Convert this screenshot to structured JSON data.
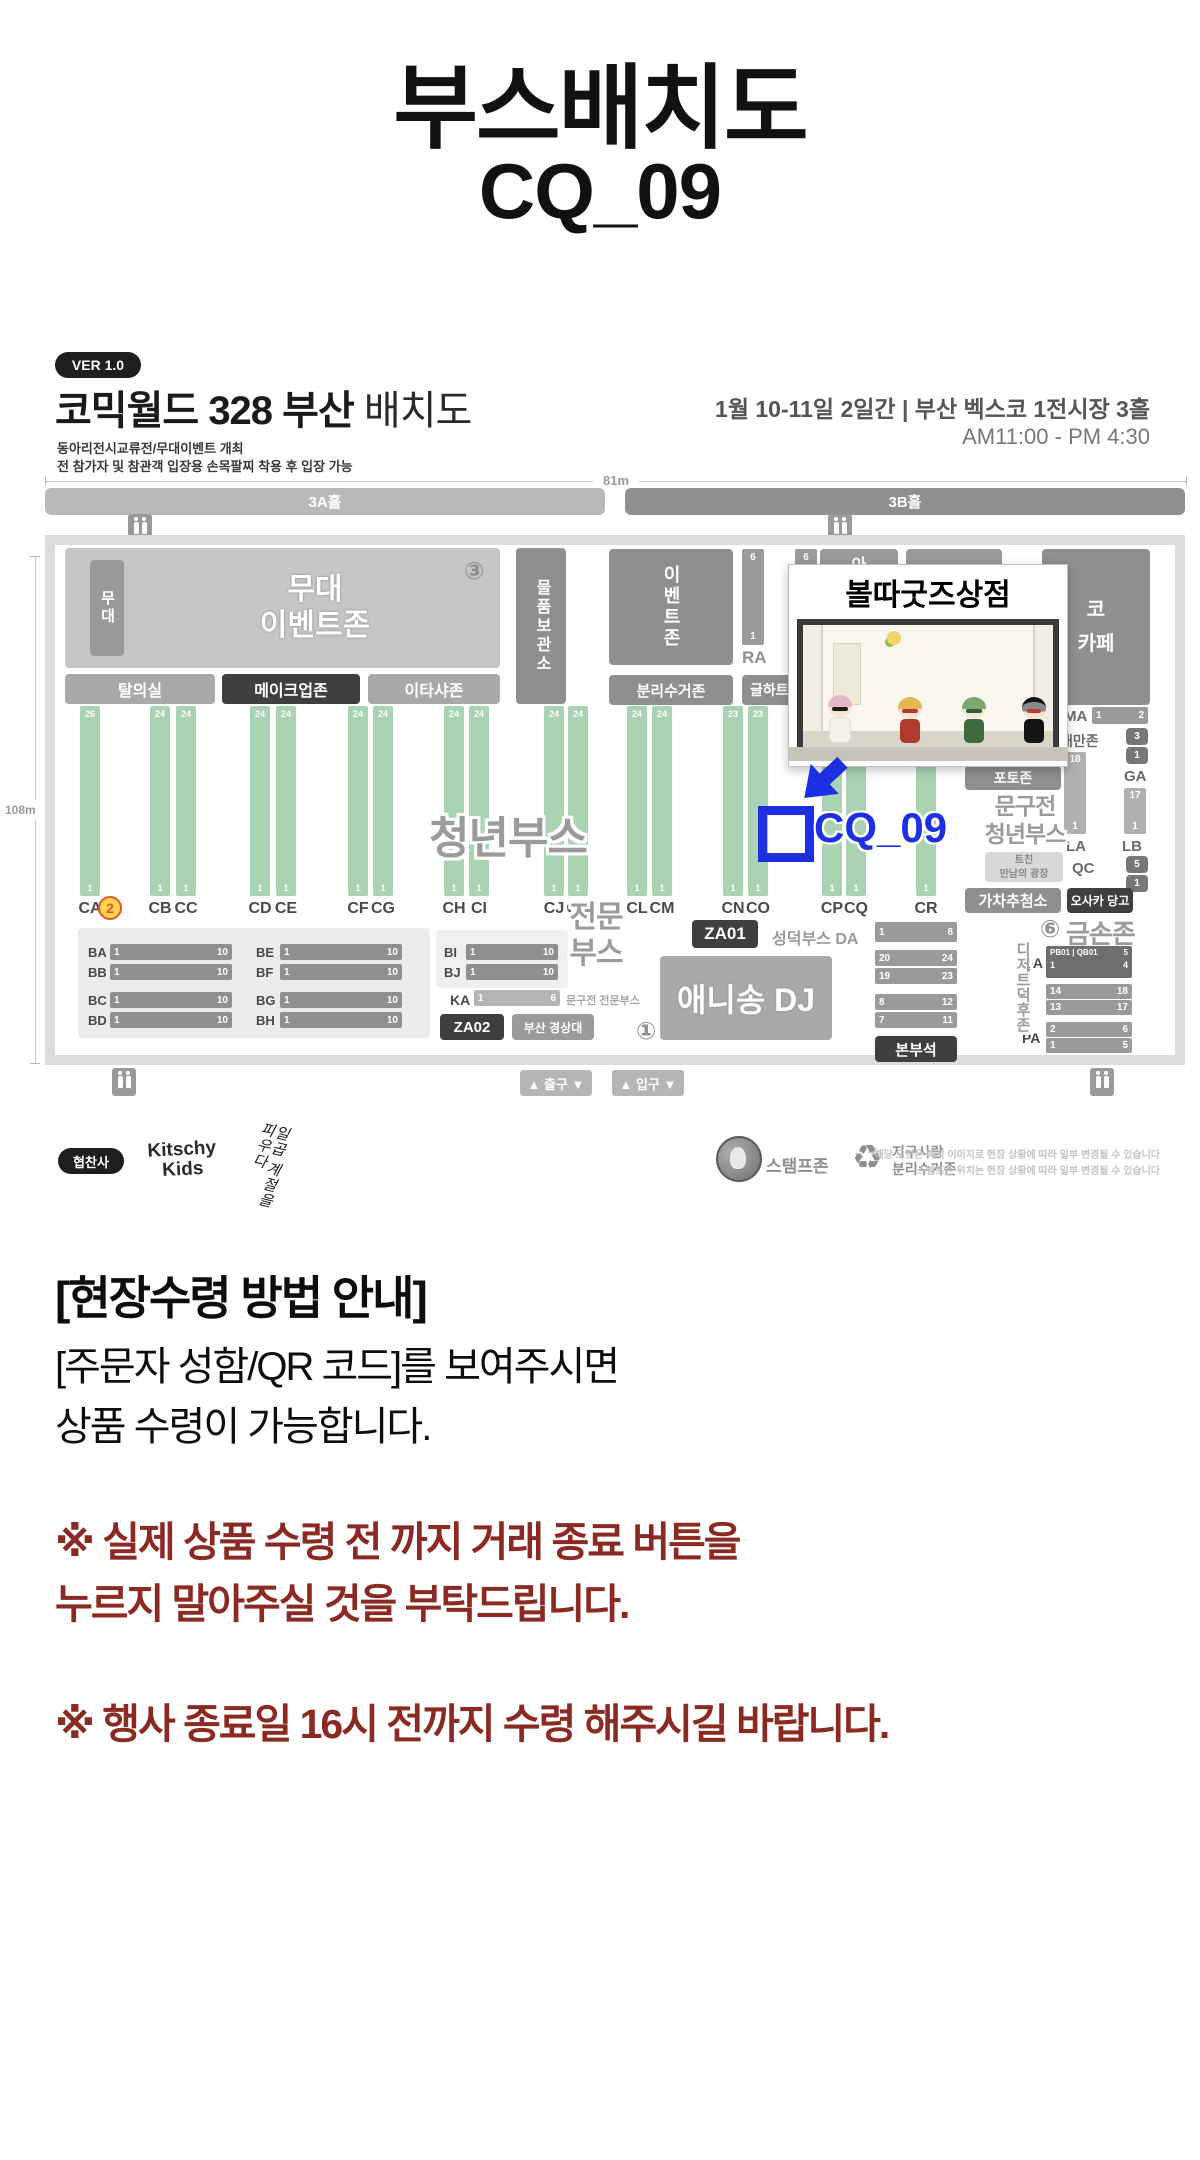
{
  "page": {
    "title_line1": "부스배치도",
    "title_line2": "CQ_09"
  },
  "colors": {
    "accent_blue": "#1d2fe3",
    "warning_maroon": "#8b2a23",
    "booth_green": "#a9d3b2"
  },
  "map": {
    "ver": "VER 1.0",
    "title_strong": "코믹월드 328 부산",
    "title_light": "배치도",
    "sub1": "동아리전시교류전/무대이벤트 개최",
    "sub2": "전 참가자 및 참관객 입장용 손목팔찌 착용 후 입장 가능",
    "date_venue": "1월 10-11일 2일간 | 부산 벡스코 1전시장 3홀",
    "hours": "AM11:00 - PM 4:30",
    "dim_w": "81m",
    "dim_h": "108m",
    "hall_a": "3A홀",
    "hall_b": "3B홀",
    "num1": "①",
    "num2": "②",
    "num3": "③",
    "num6": "⑥",
    "stage": "무대",
    "stage_zone1": "무대",
    "stage_zone2": "이벤트존",
    "dressing": "탈의실",
    "makeup": "메이크업존",
    "itasha": "이타샤존",
    "storage": "물품보관소",
    "event_zone": "이벤트존",
    "recycle_zone": "분리수거존",
    "ra_label": "RA",
    "ra_top1": "6",
    "ra_top2": "6",
    "ra_bottom": "1",
    "geul": "글하트",
    "partial_a": "아",
    "cafe_line1": "코",
    "cafe_line2": "카페",
    "youth": "청년부스",
    "pro1": "전문",
    "pro2": "부스",
    "columns": [
      {
        "label": "CA",
        "top": "26",
        "bottom": "1"
      },
      {
        "label": "CB",
        "top": "24",
        "bottom": "1"
      },
      {
        "label": "CC",
        "top": "24",
        "bottom": "1"
      },
      {
        "label": "CD",
        "top": "24",
        "bottom": "1"
      },
      {
        "label": "CE",
        "top": "24",
        "bottom": "1"
      },
      {
        "label": "CF",
        "top": "24",
        "bottom": "1"
      },
      {
        "label": "CG",
        "top": "24",
        "bottom": "1"
      },
      {
        "label": "CH",
        "top": "24",
        "bottom": "1"
      },
      {
        "label": "CI",
        "top": "24",
        "bottom": "1"
      },
      {
        "label": "CJ",
        "top": "24",
        "bottom": "1"
      },
      {
        "label": "CK",
        "top": "24",
        "bottom": "1"
      },
      {
        "label": "CL",
        "top": "24",
        "bottom": "1"
      },
      {
        "label": "CM",
        "top": "24",
        "bottom": "1"
      },
      {
        "label": "CN",
        "top": "23",
        "bottom": "1"
      },
      {
        "label": "CO",
        "top": "23",
        "bottom": "1"
      },
      {
        "label": "CP",
        "top": "",
        "bottom": "1"
      },
      {
        "label": "CQ",
        "top": "",
        "bottom": "1"
      },
      {
        "label": "CR",
        "top": "",
        "bottom": "1"
      }
    ],
    "b_rows": [
      {
        "label": "BA",
        "s": "1",
        "e": "10"
      },
      {
        "label": "BB",
        "s": "1",
        "e": "10"
      },
      {
        "label": "BC",
        "s": "1",
        "e": "10"
      },
      {
        "label": "BD",
        "s": "1",
        "e": "10"
      },
      {
        "label": "BE",
        "s": "1",
        "e": "10"
      },
      {
        "label": "BF",
        "s": "1",
        "e": "10"
      },
      {
        "label": "BG",
        "s": "1",
        "e": "10"
      },
      {
        "label": "BH",
        "s": "1",
        "e": "10"
      },
      {
        "label": "BI",
        "s": "1",
        "e": "10"
      },
      {
        "label": "BJ",
        "s": "1",
        "e": "10"
      }
    ],
    "ka_label": "KA",
    "ka_s": "1",
    "ka_e": "6",
    "ka_desc": "문구전 전문부스",
    "za01": "ZA01",
    "za02": "ZA02",
    "busan_u": "부산 경상대",
    "anisong": "애니송 DJ",
    "seongdeok": "성덕부스 DA",
    "da_s": "1",
    "da_e": "8",
    "da_rows": [
      [
        "20",
        "24"
      ],
      [
        "19",
        "23"
      ],
      [
        "8",
        "12"
      ],
      [
        "7",
        "11"
      ]
    ],
    "hq": "본부석",
    "photo": "포토존",
    "mungu1": "문구전",
    "mungu2": "청년부스",
    "tchin1": "트친",
    "tchin2": "만남의 광장",
    "gacha": "가차추첨소",
    "osaka": "오사카 당고",
    "gold": "금손존",
    "dessert": "디저트덕후존",
    "ma": "MA",
    "ma_s": "1",
    "ma_e": "2",
    "taiwan": "대만존",
    "tw1": "3",
    "tw2": "1",
    "ga": "GA",
    "la_top": "18",
    "la_bot": "1",
    "la": "LA",
    "lb_top": "17",
    "lb_bot": "1",
    "lb": "LB",
    "qc": "QC",
    "qc1": "5",
    "qc2": "1",
    "qa": "QA",
    "qa_r1l": "PB01 | QB01",
    "qa_r1r": "5",
    "qa_r2l": "1",
    "qa_r2r": "4",
    "mid_r1l": "14",
    "mid_r1r": "18",
    "mid_r2l": "13",
    "mid_r2r": "17",
    "pa": "PA",
    "pa_r1l": "2",
    "pa_r1r": "6",
    "pa_r2l": "1",
    "pa_r2r": "5",
    "exit": "▲ 출구 ▼",
    "entrance": "▲ 입구 ▼",
    "shop_title": "볼따굿즈상점",
    "booth": "CQ_09",
    "legend": {
      "sponsor": "협찬사",
      "kitschy1": "Kitschy",
      "kitschy2": "Kids",
      "calligraphy": "일곱 계절을 피우다",
      "stamp": "스탬프존",
      "recycle_icon": "♻",
      "earth1": "지구사랑",
      "earth2": "분리수거존",
      "disclaimer1": "*해당 도면은 예시 이미지로 현장 상황에 따라 일부 변경될 수 있습니다",
      "disclaimer2": "스탬프존 위치는 현장 상황에 따라 일부 변경될 수 있습니다"
    }
  },
  "notice": {
    "header": "[현장수령 방법 안내]",
    "line1": "[주문자 성함/QR 코드]를 보여주시면",
    "line2": "상품 수령이 가능합니다.",
    "warn1a": "※ 실제 상품 수령 전 까지 거래 종료 버튼을",
    "warn1b": "누르지 말아주실 것을 부탁드립니다.",
    "warn2": "※ 행사 종료일 16시 전까지 수령 해주시길 바랍니다."
  }
}
